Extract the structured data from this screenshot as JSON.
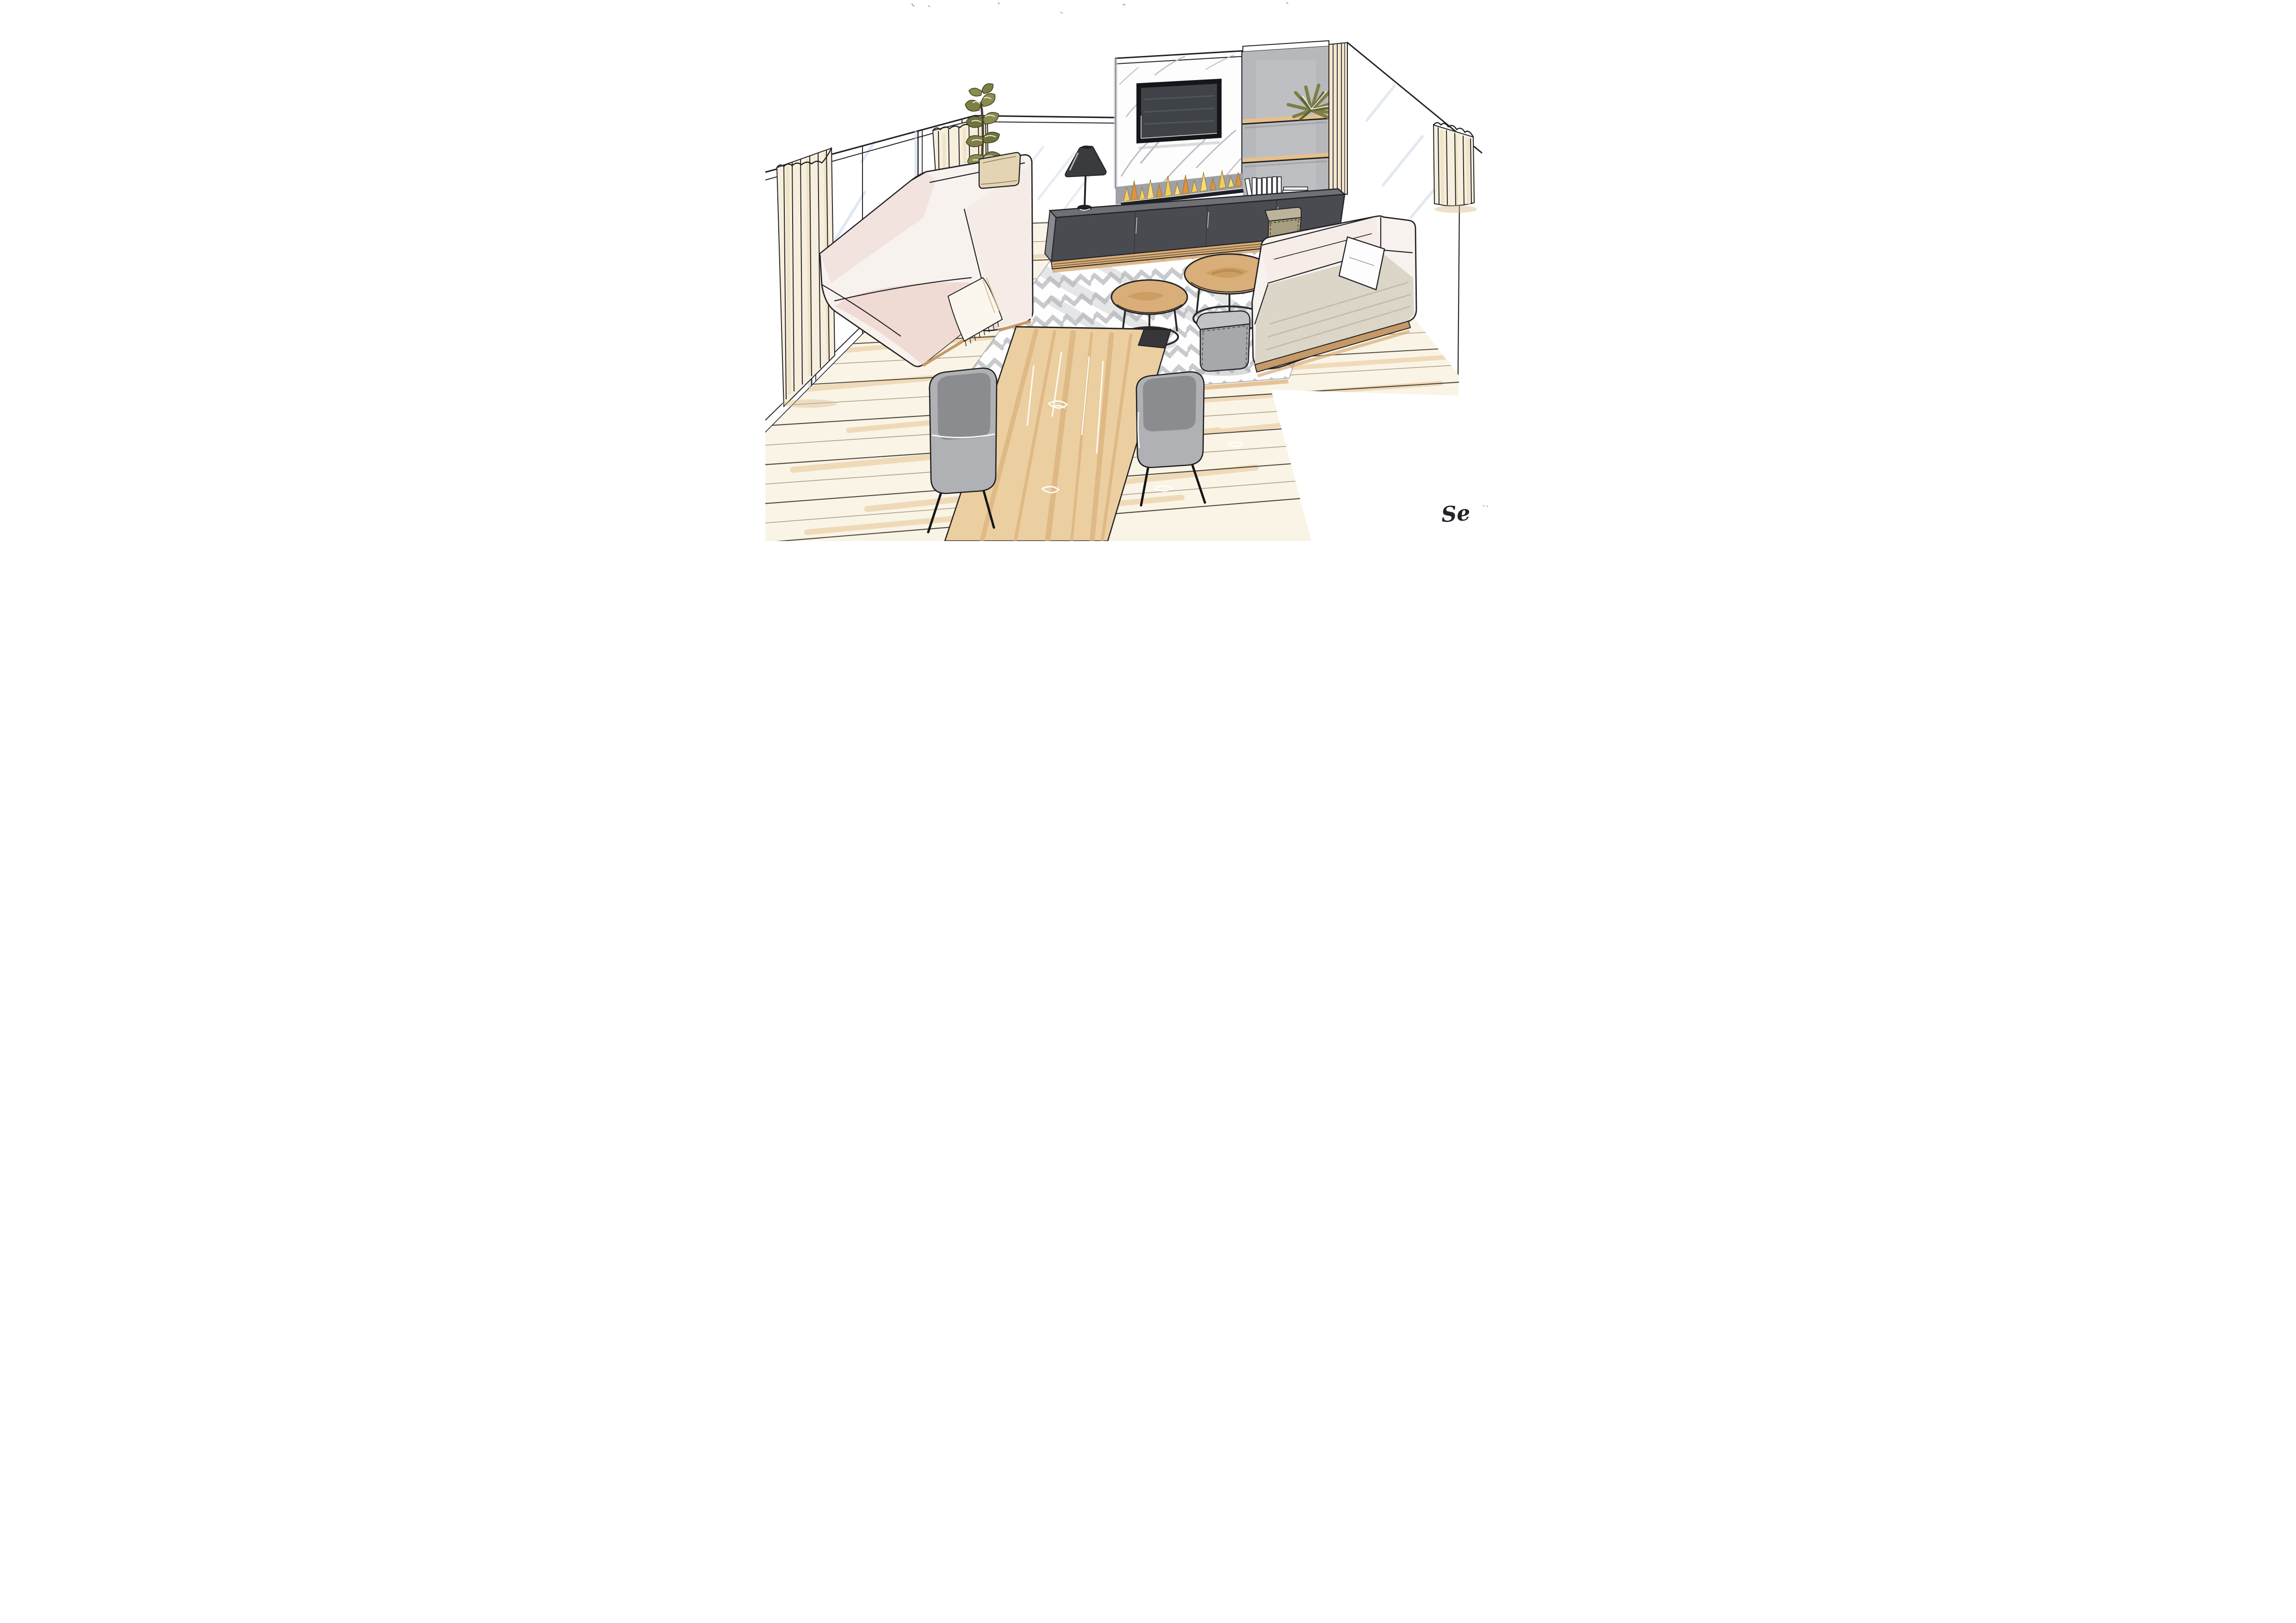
{
  "artwork": {
    "title": "Living room interior perspective sketch",
    "medium": "hand-drawn marker and ink rendering",
    "signature": "Se"
  },
  "colors": {
    "paper": "#ffffff",
    "ink": "#222226",
    "glass_streak": "#c7d5ea",
    "curtain_cream": "#f7efdd",
    "curtain_shade": "#efe2c4",
    "floor_base": "#faf4e6",
    "floor_streak": "#e8c99b",
    "rug_white": "#fefefe",
    "rug_chevron": "#c3c4c8",
    "marble_white": "#fdfdfd",
    "marble_vein": "#b9bdc4",
    "tv_frame": "#151619",
    "tv_screen": "#3f4348",
    "gray_wall": "#b7b8bc",
    "shelf_wood": "#e5c08c",
    "trim_wood": "#f4e6cc",
    "bench_top": "#6e7075",
    "bench_front": "#4a4b50",
    "bench_side": "#8a8b90",
    "plinth_wood": "#d9ad77",
    "flame_yellow": "#f3cf5a",
    "flame_orange": "#e0923c",
    "burner_black": "#1e1f22",
    "lamp_black": "#3a3b3e",
    "sofa_white": "#f8f2ee",
    "sofa_blush": "#efd9d2",
    "sofa_blush_light": "#f3e3de",
    "sofa_seat_gray": "#dcd6c9",
    "sofa_base_wood": "#c59a66",
    "pillow_cream": "#e3d5b4",
    "pillow_white": "#fdfdfd",
    "olive_leaf": "#7d7f46",
    "olive_dark": "#616433",
    "khaki_pouf": "#a79f80",
    "khaki_pouf_top": "#bcb49a",
    "gray_pouf": "#c2c3c6",
    "gray_pouf_front": "#a7a8ab",
    "chair_shell": "#b0b1b4",
    "chair_seat": "#8b8c8f",
    "table_wood": "#eccfa0",
    "table_streak": "#d9ae78",
    "table_dark_band": "#37373a",
    "shadow_gray": "#a3a4a9",
    "shadow_tan": "#c9a27a"
  },
  "scene_elements": [
    "glass-window-wall",
    "sheer-curtains-left",
    "tall-potted-plant",
    "blush-sectional-sofa",
    "beige-cushion",
    "fringed-throw-blanket",
    "black-table-lamp",
    "marble-media-panel",
    "wall-mounted-tv",
    "linear-bio-ethanol-fireplace",
    "charcoal-media-bench",
    "khaki-pouf",
    "gray-shelf-wall",
    "wood-floating-shelves",
    "white-books",
    "shelf-plant",
    "cream-sofa-right",
    "white-pillow",
    "round-nesting-coffee-tables",
    "gray-cube-pouf",
    "chevron-area-rug",
    "oak-plank-floor",
    "wood-dining-table",
    "gray-dining-chairs",
    "sheer-curtain-right",
    "artist-signature"
  ]
}
